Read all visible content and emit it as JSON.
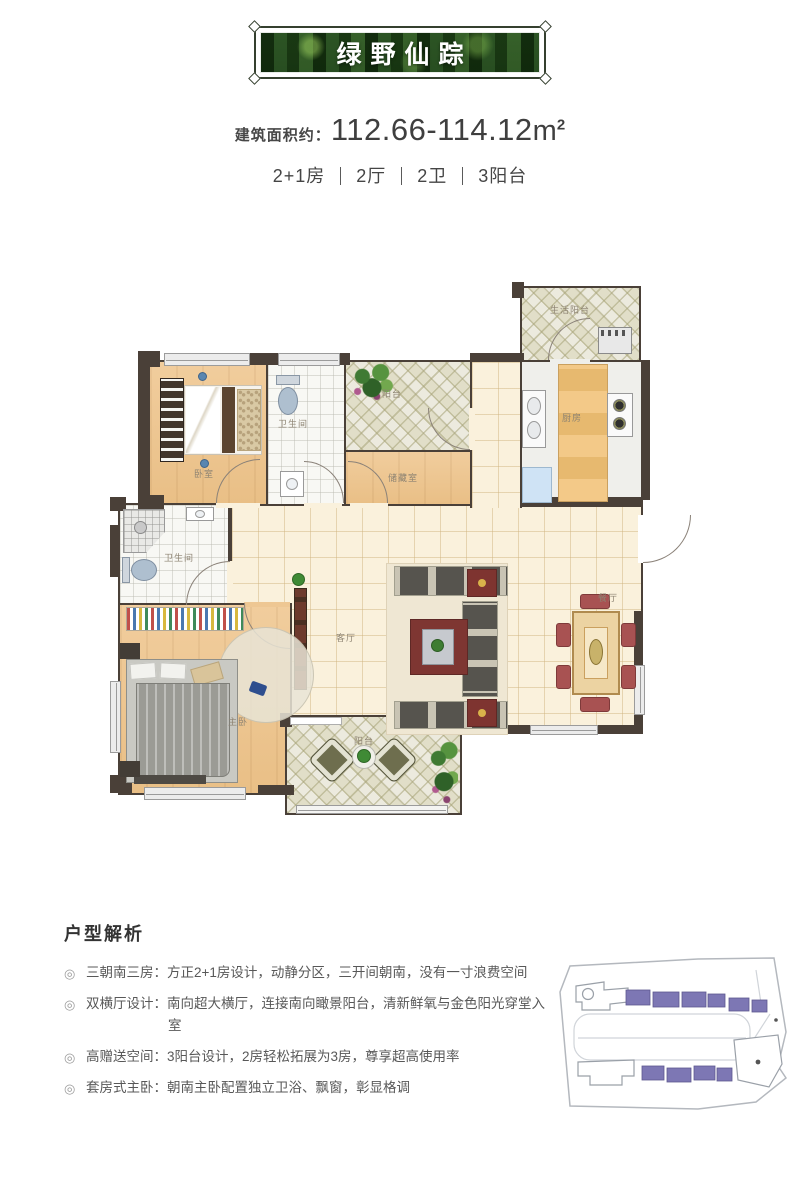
{
  "banner": {
    "title": "绿野仙踪"
  },
  "area": {
    "label": "建筑面积约：",
    "value": "112.66-114.12",
    "unit": "m",
    "unit_exp": "2"
  },
  "specs": {
    "items": [
      "2+1房",
      "2厅",
      "2卫",
      "3阳台"
    ]
  },
  "floorplan": {
    "rooms": {
      "bedroom2": "卧室",
      "bath2": "卫生间",
      "balcony_top": "阳台",
      "storage": "储藏室",
      "life_balcony": "生活阳台",
      "kitchen": "厨房",
      "living": "客厅",
      "dining": "餐厅",
      "master_bath": "卫生间",
      "master_bedroom": "主卧",
      "balcony_south": "阳台"
    }
  },
  "analysis": {
    "title": "户型解析",
    "marker": "◎",
    "items": [
      {
        "label": "三朝南三房：",
        "text": "方正2+1房设计，动静分区，三开间朝南，没有一寸浪费空间"
      },
      {
        "label": "双横厅设计：",
        "text": "南向超大横厅，连接南向瞰景阳台，清新鲜氧与金色阳光穿堂入室"
      },
      {
        "label": "高赠送空间：",
        "text": "3阳台设计，2房轻松拓展为3房，尊享超高使用率"
      },
      {
        "label": "套房式主卧：",
        "text": "朝南主卧配置独立卫浴、飘窗，彰显格调"
      }
    ]
  },
  "colors": {
    "wall": "#4a4038",
    "wood": "#eec793",
    "tile_cream": "#faf1dc",
    "tile_balcony": "#eceade",
    "bath_tile": "#f8f8f4",
    "dining_chair": "#a85252",
    "accent_purple": "#7d77b4",
    "banner_green": "#2c5424"
  }
}
